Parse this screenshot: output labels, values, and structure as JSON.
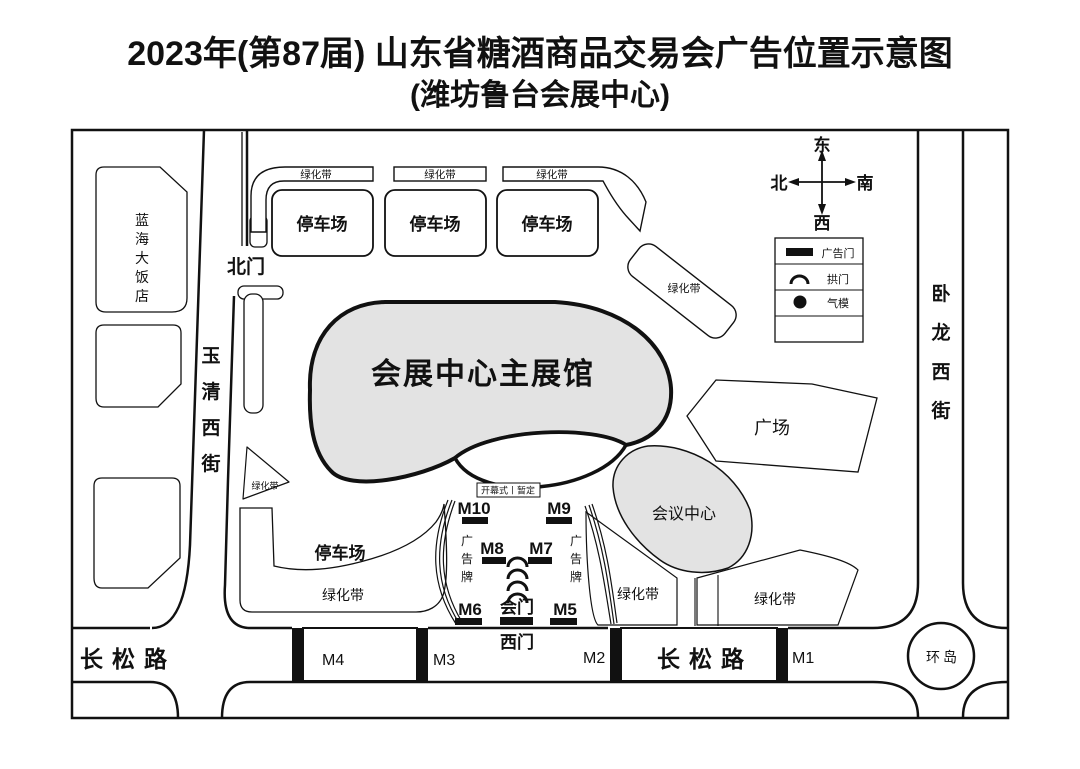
{
  "title": {
    "line1": "2023年(第87届) 山东省糖酒商品交易会广告位置示意图",
    "line2": "(潍坊鲁台会展中心)"
  },
  "compass": {
    "east": "东",
    "north": "北",
    "south": "南",
    "west": "西"
  },
  "legend": {
    "items": [
      {
        "icon": "ad-gate-bar",
        "label": "广告门"
      },
      {
        "icon": "arch",
        "label": "拱门"
      },
      {
        "icon": "balloon",
        "label": "气模"
      }
    ]
  },
  "roads": {
    "changsong": "长松路",
    "yuqing_west_street": "玉清西街",
    "wolong_west_street": "卧龙西街",
    "roundabout": "环岛"
  },
  "gates": {
    "north": "北门",
    "west": "西门",
    "hui": "会门"
  },
  "areas": {
    "hotel": "蓝海大饭店",
    "main_hall": "会展中心主展馆",
    "conference_center": "会议中心",
    "plaza": "广场",
    "parking": "停车场",
    "green_belt": "绿化带",
    "billboard": "广告牌"
  },
  "markers": {
    "m1": "M1",
    "m2": "M2",
    "m3": "M3",
    "m4": "M4",
    "m5": "M5",
    "m6": "M6",
    "m7": "M7",
    "m8": "M8",
    "m9": "M9",
    "m10": "M10"
  },
  "note_opening": "开幕式丨暂定",
  "colors": {
    "ink": "#111111",
    "building_fill": "#e3e3e3",
    "background": "#ffffff"
  }
}
